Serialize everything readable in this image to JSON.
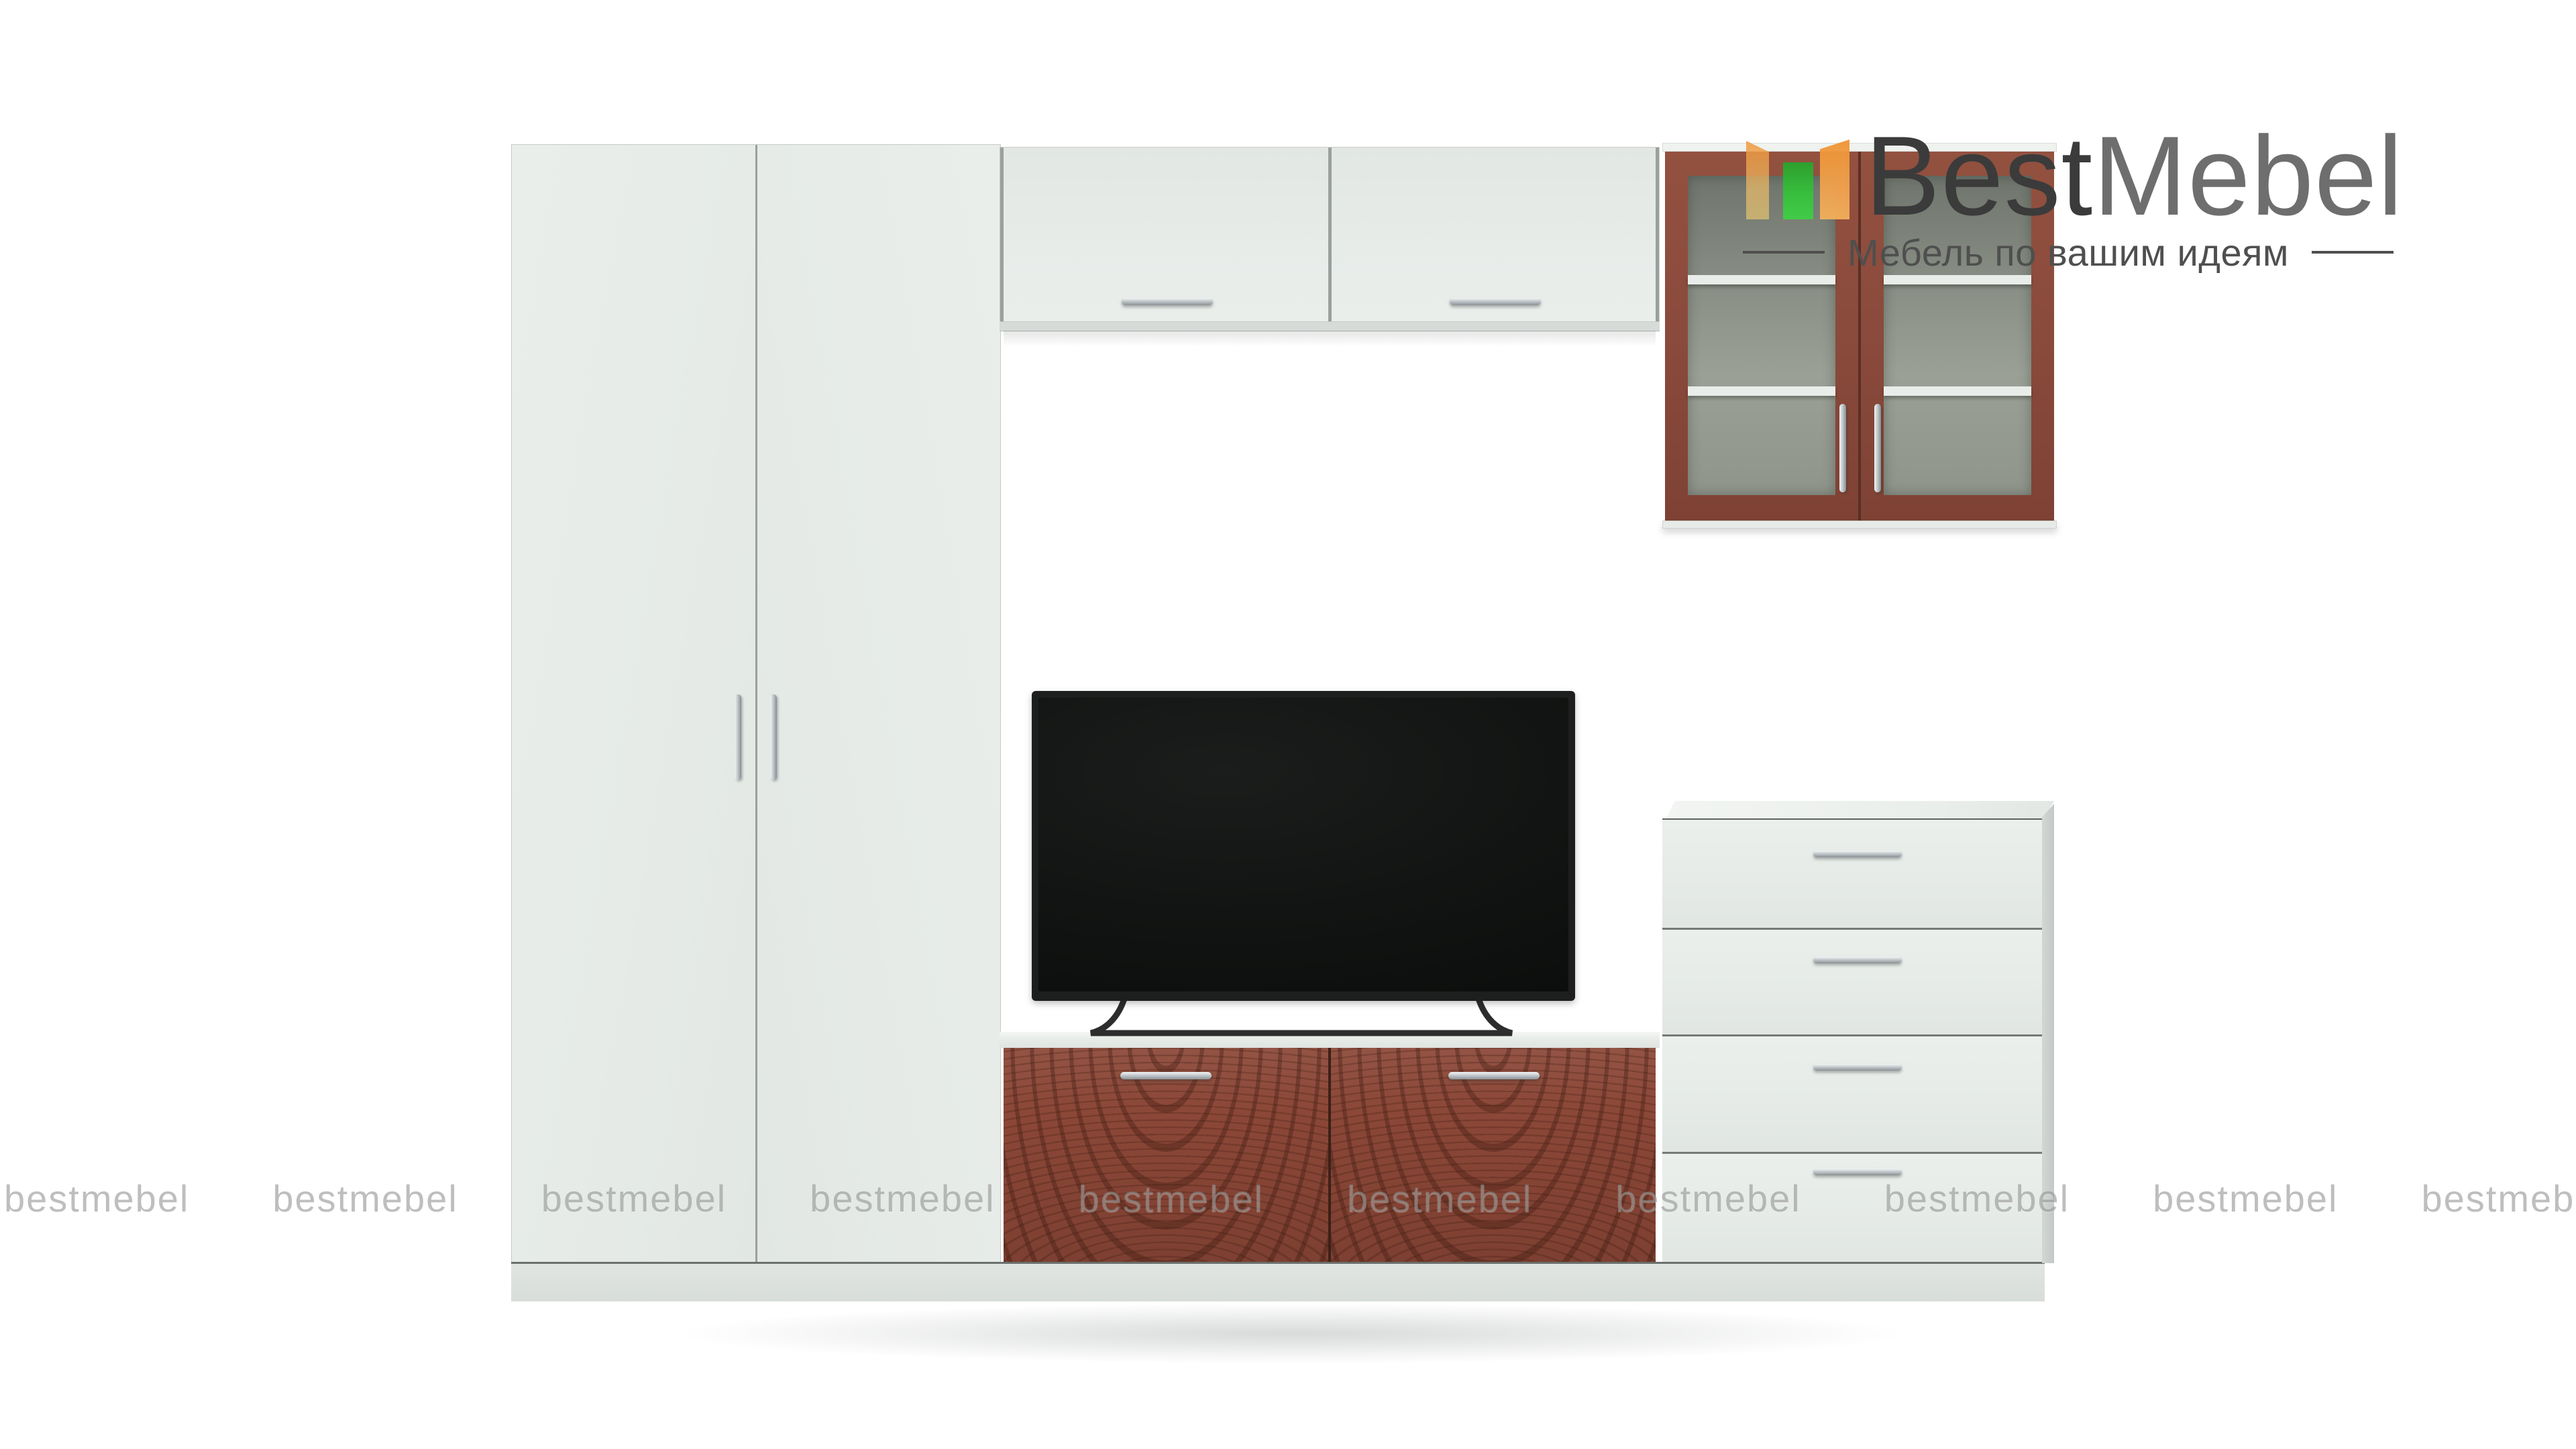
{
  "brand": {
    "name_primary": "Best",
    "name_secondary": "Mebel",
    "name_primary_color": "#3B3B3B",
    "name_secondary_color": "#6E6E6E",
    "tagline": "Мебель по вашим идеям",
    "tagline_color": "#4F4F4F",
    "logo_icon": {
      "name": "bestmebel-logo-icon",
      "left_panel_color": "#F0963A",
      "left_panel_fade_color": "#E9C771",
      "center_panel_color": "#35C13A",
      "right_panel_color": "#EF9434"
    }
  },
  "watermark": {
    "text": "bestmebel",
    "count": 10,
    "color": "rgba(118,120,118,0.48)"
  },
  "scene": {
    "background_color": "#FFFFFF",
    "furniture_white_color": "#E6EBE7",
    "accent_red_brown_color": "#8B4737",
    "glass_tint_color": "#8B9188",
    "plinth_color": "#DCE1DD",
    "tv_screen_color": "#121413",
    "handle_metal_color": "#C3C9CD",
    "items": {
      "wardrobe": {
        "doors": 2,
        "handle_type": "vertical-bar"
      },
      "bridge_cabinet": {
        "doors": 2,
        "handle_type": "horizontal-bar"
      },
      "glass_display_cabinet": {
        "doors": 2,
        "shelves_per_door": 2,
        "handle_type": "vertical-bar"
      },
      "tv": {
        "type": "flat-screen-on-legs"
      },
      "tv_cabinet": {
        "doors": 2,
        "front_pattern": "embossed-waves"
      },
      "chest_of_drawers": {
        "drawers": 4,
        "handle_type": "horizontal-bar"
      }
    }
  }
}
